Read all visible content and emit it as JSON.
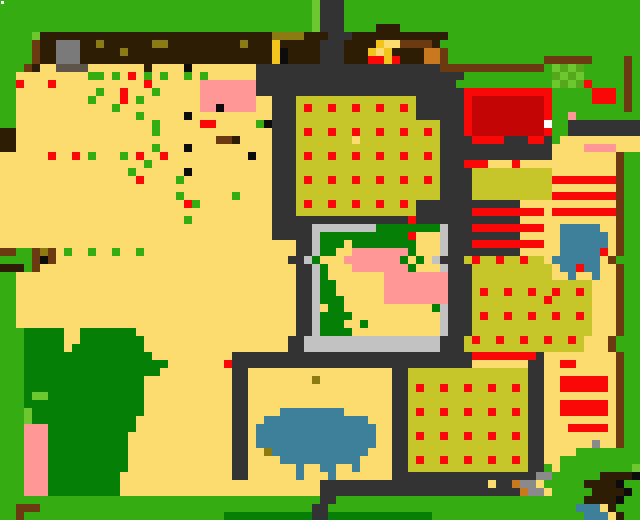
{
  "app": {
    "title": "pixel-farm-world-map"
  },
  "map": {
    "cols": 80,
    "rows": 65,
    "cell_size": 8,
    "cursor": {
      "x": 1,
      "y": 1,
      "size": 3,
      "color": "#FFFFFF"
    },
    "palette": {
      "G": "#35AC12",
      "g": "#057F05",
      "H": "#6CC82E",
      "n": "#55A81C",
      "T": "#FCDC6F",
      "K": "#C6C62B",
      "R": "#FA0707",
      "r": "#C30505",
      "P": "#FE9795",
      "U": "#3E7F99",
      "D": "#333333",
      "B": "#2D1D04",
      "b": "#6B3A10",
      "o": "#C8791F",
      "y": "#8C7B12",
      "Y": "#F2C51E",
      "A": "#7A7A7A",
      "C": "#C2C2C2",
      "a": "#8A8A8A",
      "k": "#0C0C0C",
      "W": "#FFFFFF",
      "s": "#5E554A"
    },
    "legend": {
      "G": "grass",
      "g": "tree-canopy",
      "H": "light-grass",
      "n": "garden-sprout",
      "T": "sandy-soil",
      "K": "crop-field",
      "R": "red-crop",
      "r": "barn-roof-dark-red",
      "P": "pink-roof",
      "U": "water",
      "D": "stone-path",
      "B": "dark-wood",
      "b": "fence-wood",
      "o": "orange-crate",
      "y": "olive-item",
      "Y": "gold-item",
      "A": "stone-building",
      "C": "stone-wall",
      "a": "gravel",
      "k": "black-item",
      "W": "cursor",
      "s": "building-shadow"
    },
    "grid": [
      "GGGGGGGGGGGGGGGGGGGGGGGGGGGGGGGGGGGGGGGHDDDGGGGGGGGGGGGGGGGGGGGGGGGGGGGGGGGGGGG",
      "GGGGGGGGGGGGGGGGGGGGGGGGGGGGGGGGGGGGGGGHDDDGGGGGGGGGGGGGGGGGGGGGGGGGGGGGGGGGGGG",
      "GGGGGGGGGGGGGGGGGGGGGGGGGGGGGGGGGGGGGGGHDDDGGGGGGGGGGGGGGGGGGGGGGGGGGGGGGGGGGGG",
      "GGGGGGGGGGGGGGGGGGGGGGGGGGGGGGGGGGGGGGGHDDDGGGGBBBGGGGGGGGGGGGGGGGGGGGGGGGGGGGG",
      "GGGGHBBBBBBBBBBBBBBBBBBBBBBBBBBBBByyyyBBBDDDBBBBBBBBBBBBGGGGGGGGGGGGGGGGGGGGGGGG",
      "GGGGbBBAAABByBBBBBByyBBBBBBBBByBBBYBBBBBDDDBBBBYTTbbbbBGGGGGGGGGGGGGGGGGGGGGGGGG",
      "GGGGbBBAAABBBBByBBBBBBBBBBBBBBBBBBYkBBBBDDDBBBYTYBBBBoobGGGGGGGGGGGGGGGGGGGGGGGG",
      "GGGGbBBAAABBBBBBBBBBBBBBBBBBBBBBBBYkBBBBDDDBBBRRYRBBBoobGGGGGGGGGGGGbbbbbbGGGGbG",
      "GGGbBTTssssTTTTTTTBTTTTkTTTTTTTTDDDDDDDDDDDDDDDDDDDDDDDbbbbbbbbbbbbbGHnHnGGGGGbG",
      "GGTTTTTTTTTGGTGTRTGTGTTGTGTTTTTTDDDDDDDDDDDDDDDDDDDDDDDDDDGGGGGGGGGGGnHnHGGGGGbG",
      "GGRTTTRTTTTTTTTTTTRTTTTTTPPPPPPPDDDDDDDDDDDDDDDDDDDDDDDDDGGGGGGGGGGGGHnHnRGGGGbG",
      "GGTTTTTTTTTTGTTRTTTGTTTTTPPPPPPPDDDDDDDDDDDDDDDDDDDDDDDDDDRRRRRRRRRRRGGGGGRRRGbG",
      "GGTTTTTTTTTGTTTRTGTTTTTTTPPPPPPPTTDDDKKKKKKKKKKKKKKKDDDDDDRrrrrrrrrrRGGGGGRRRGbG",
      "GGTTTTTTTTTTTTGTTTTTTTTTTPPkPPPPTTDDDKRKKRKKRKKRKKRKDDDDDDRrrrrrrrrrRGGGGGGGGGbG",
      "GGTTTTTTTTTTTTTTTGTTTTTkTTTTTTTTTTDDDKKKKKKKKKKKKKKKDDDDDDRrrrrrrrrrRGGPGGGGGGGG",
      "GGTTTTTTTTTTTTTTTTTGTTTTTRRTTTTTGkDDDKKKKKKKKKKKKKKKKKKDDDRrrrrrrrrrWGGDDDDDDDDD",
      "BBTTTTTTTTTTTTTTTTTGTTTTTTTTTTTTTTDDDKRKKRKKRKKRKKRKKRKDDDRrrrrrrrrrRGGDDDDDDDDD",
      "BBTTTTTTTTTTTTTTTTTTTTTTTTTbbBTTTTDDDKKKKKKKTKKKKKKKKKKDDDDRRRRDDDRRDGTTTTTTTTTT",
      "BBTTTTTTTTTTTTTTTTTGTTTkTTTTTTTTTTDDDKKKKKKKKKKKKKKKKKKDDDDDDDDDDDDDDTTTTPPPPTTT",
      "TTTTTTRTTRTGTTTGTRTTRTTTTTTTTTTkTTDDDKRKKRKKRKKRKKRKKRKDDDDDDDDDDDDDDTTTTTTTTbGG",
      "TTTTTTTTTTTTTTTTTTGTTTTTTTTTTTTTTTDDDKKKKKKKKKKKKKKKKKKDDDRRRTTTRTTTTTTTTTTTTbGG",
      "TTTTTTTTTTTTTTTTGTTTTTTkTTTTTTTTTTDDDKKKKKKKKKKKKKKKKKKDDDDKKKKKKKKKKTTTTTTTTbGG",
      "TTTTTTTTTTTTTTTTTRTTTTGTTTTTTTTTTTDDDKRKKRKKRKKRKKRKKRKDDDDKKKKKKKKKKRRRRRRRRbGG",
      "TTTTTTTTTTTTTTTTTTTTTTTTTTTTTTTTTTDDDKKKKKKKKKKKKKKKKKKDDDDKKKKKKKKKKTTTTTTTTbGG",
      "TTTTTTTTTTTTTTTTTTTTTTGTTTTTTGTTTTDDDKKKKKKKKKKKKKKKKKKDDDDKKKKKKKKKKRRRRRRRRbGG",
      "TTTTTTTTTTTTTTTTTTTTTTTRGTTTTTTTTTDDDKRKKRKKRKKRKKRKDDDDDDDDDDDDDTTTTTTTTTTTTbGG",
      "TTTTTTTTTTTTTTTTTTTTTTTTTTTTTTTTTTDDDKKKKKKKKKKKKKKKDDDDDDDRRRRRRRRRTRRRRRRRRbGG",
      "TTTTTTTTTTTTTTTTTTTTTTTGTTTTTTTTTTDDDDDDDDDDDDDDDDDRDDDDDDDDDDDDDTTTTTTTTTTTTbGG",
      "TTTTTTTTTTTTTTTTTTTTTTTTTTTTTTTTTTDDDDDCCCCCCCCggggggggCDDDRRRRRRRRRTTUUUUUTTbGG",
      "TTTTTTTTTTTTTTTTTTTTTTTTTTTTTTTTTTDDDDDCgggggggggggRTTTCDDDDDDDDDTTTTTUUUUUUTbGG",
      "TTTTTTTTTTTTTTTTTTTTTTTTTTTTTTTTTTTTTDDCgggTggggggggTTTCDDDRRRRRRRRRTTUUUUUUTbGG",
      "bbGGbybTGTTGTTGTTGTTTTTTTTTTTTTTTTTTTDDCggTTPPPPPPPgTTTCDDDDDDDDDTTTTTUUUUURTbGG",
      "GGGGbkbTTTTTTTTTTTTTTTTTTTTTTTTTTTTTDDCgTTTPPPPPPPgTgTCDDDKRKKRKKRKKTUUUUUUTbGG",
      "BBBGbTTTTTTTTTTTTTTTTTTTTTTTTTTTTTTTTDDCgTTTPPPPPPPgTTTCDDDKKKKKKKKKKTUURUUTTbGG",
      "GGTTTTTTTTTTTTTTTTTTTTTTTTTTTTTTTTTTTDDCgTTTTTTTPPPPPPPPDDDKKKKKKKKKKTTUTTUTTbGG",
      "GGTTTTTTTTTTTTTTTTTTTTTTTTTTTTTTTTTTTDDCggTTTTTTPPPPPPPPDDDKKKKKKKKKKKKKKKTTTbGG",
      "GGTTTTTTTTTTTTTTTTTTTTTTTTTTTTTTTTTTTDDCggTTTTTTPPPPPPPPDDDKRKKRKKRKKRKKRKTTTbGG",
      "GGTTTTTTTTTTTTTTTTTTTTTTTTTTTTTTTTTTTDDCgggTTTTTPPPPPPPPDDDKKKKKKKKKRKKKKKTTTbGG",
      "GGTTTTTTTTTTTTTTTTTTTTTTTTTTTTTTTTTTTDDCTggTTTTTTTTTTTgCDDDKKKKKKKKKKKKKKKTTTbGG",
      "GGTTTTTTTTTTTTTTTTTTTTTTTTTTTTTTTTTTTDDCggggTTTTTTTTTTTCDDDKRKKRKKRKKRKKRKTTTbGG",
      "GGTTTTTTTTTTTTTTTTTTTTTTTTTTTTTTTTTTTDDCgggTTgTTTTTTTTTCDDDKKKKKKKKKKKKKKKTTTbGG",
      "GGGgggggTTgggggggTTTTTTTTTTTTTTTTTTTTDDCggggTTTTTTTTTTTCDDDKKKKKKKKKKKKKKKTTTbGG",
      "GGGgggggTTggggggggTTTTTTTTTTTTTTTTTTDDCCCCCCCCCCCCCCCCCDDDKRKKRKKRKKRKKRKTTTbGG",
      "GGGgggggTgggggggggTTTTTTTTTTTTTTTTTTDDCCCCCCCCCCCCCCCCCDDDKKKKKKKKKKKKKKKTTTbGG",
      "GGGggggggggggggggggTTTTTTTTTTDDDDDDDDDDDDDDDDDDDDDDDDDDDDDDRRRRRRRRDTTTTTTTTTbGG",
      "GGGggggggggggggggggggTTTTTTTRDDDDDDDDDDDDDDDDDDDDDDDDDDDDDDTTTTTTTDDTTRRTTTTTbGG",
      "GGGgggggggggggggggggTTTTTTTTTDDTTTTTTTTTTTTTTTTTTDDKKKKKKKKKKKKKKKDDTTTTTTTTTbGG",
      "GGGgggggggggggggggTTTTTTTTTTTDDTTTTTTTTyTTTTTTTTTDDKKKKKKKKKKKKKKKDDTTRRRRRRTbGG",
      "GGGgggggggggggggggTTTTTTTTTTTDDTTTTTTTTTTTTTTTTTTDDKRKKRKKRKKRKKRKDDTTRRRRRRTbGG",
      "GGGgHHggggggggggggTTTTTTTTTTTDDTTTTTTTTTTTTTTTTTTDDKKKKKKKKKKKKKKKDDTTTTTTTTTbGG",
      "GGGgggggggggggggggTTTTTTTTTTTDDTTTTTTTTTTTTTTTTTTDDKKKKKKKKKKKKKKKDDTTRRRRRRTbGG",
      "GGGHggggggggggggggTTTTTTTTTTTDDTTTTUUUUUUUUTTTTTTDDKRKKRKKRKKRKKRKDDTTRRRRRRTbGG",
      "GGGHgggggggggggggTTTTTTTTTTTTDDTTUUUUUUUUUUUUUTTTDDKKKKKKKKKKKKKKKDDTTTTTTTTTbGG",
      "GGGPPPgggggggggggTTTTTTTTTTTTDDTUUUUUUUUUUUUUUUTTDDKKKKKKKKKKKKKKKDDTTTRRRRRTbGG",
      "GGGPPPggggggggggTTTTTTTTTTTTTDDTUUUUUUUUUUUUUUUTTDDKRKKRKKRKKRKKRKDDTTTTTTTTTbGG",
      "GGGPPPggggggggggTTTTTTTTTTTTTDDTUUUUUUUUUUUUUUUTTDDKKKKKKKKKKKKKKKDDTTTTTTaTTbGG",
      "GGGPPPggggggggggTTTTTTTTTTTTTDDTTyUUUUUUUUUUUUTTTDDKKKKKKKKKKKKKKKDDTTTTGGGGGGGG",
      "GGGPPPggggggggggTTTTTTTTTTTTTDDTTTTUUUUUUUUUUTTTTDDKRKKRKKRKKRKKRKDDTTGGGGGGGGGG",
      "GGGPPPggggggggggTTTTTTTTTTTTTDDTTTTTTUTTUUTTUTTTTDDKKKKKKKKKKKKKKKDDGTGGGGGGGGGH",
      "GGGPPPgggggggggTTTTTTTTTTTTTTDDTTTTTTUTTTUTTTTTTTDDDDDDDDDDDDDDDDDDaaGGGGGGBBBBk",
      "GGGPPPgggggggggTTTTTTTTTTTTTTTTTTTTTTTTTDDDDDDDDDDDDDDDDDDDDDTDDoaaTGGGGGBBBBk",
      "GGGPPPgggggggggTTTTTTTTTTTTTTTTTTTTTTTTTDDDDDDDDDDDDDDDDDDDDDDDDDoaaTGGGGGBBBBk",
      "GGGGGGGGGGGGGGGGGGGGGGGGGGGGGGGGGGGGGGGGDDGGGGGGGGGGGGGGGGGGGGGGGGGGGGGGGBBBBk",
      "GGbbbGGGGGGGGGGGGGGGGGGGGGGGGGGGGGGGGGGDDGGGGGGGGGGGGGGGGGGGGGGGGGGGGGGGUUUTB",
      "GGbGGGGGGGGGGGGGGGGGGGGGGGGGgggggggggggDDgggggggggggggGGGGGGGGGGGGGGGGGGGUUUTB"
    ]
  }
}
